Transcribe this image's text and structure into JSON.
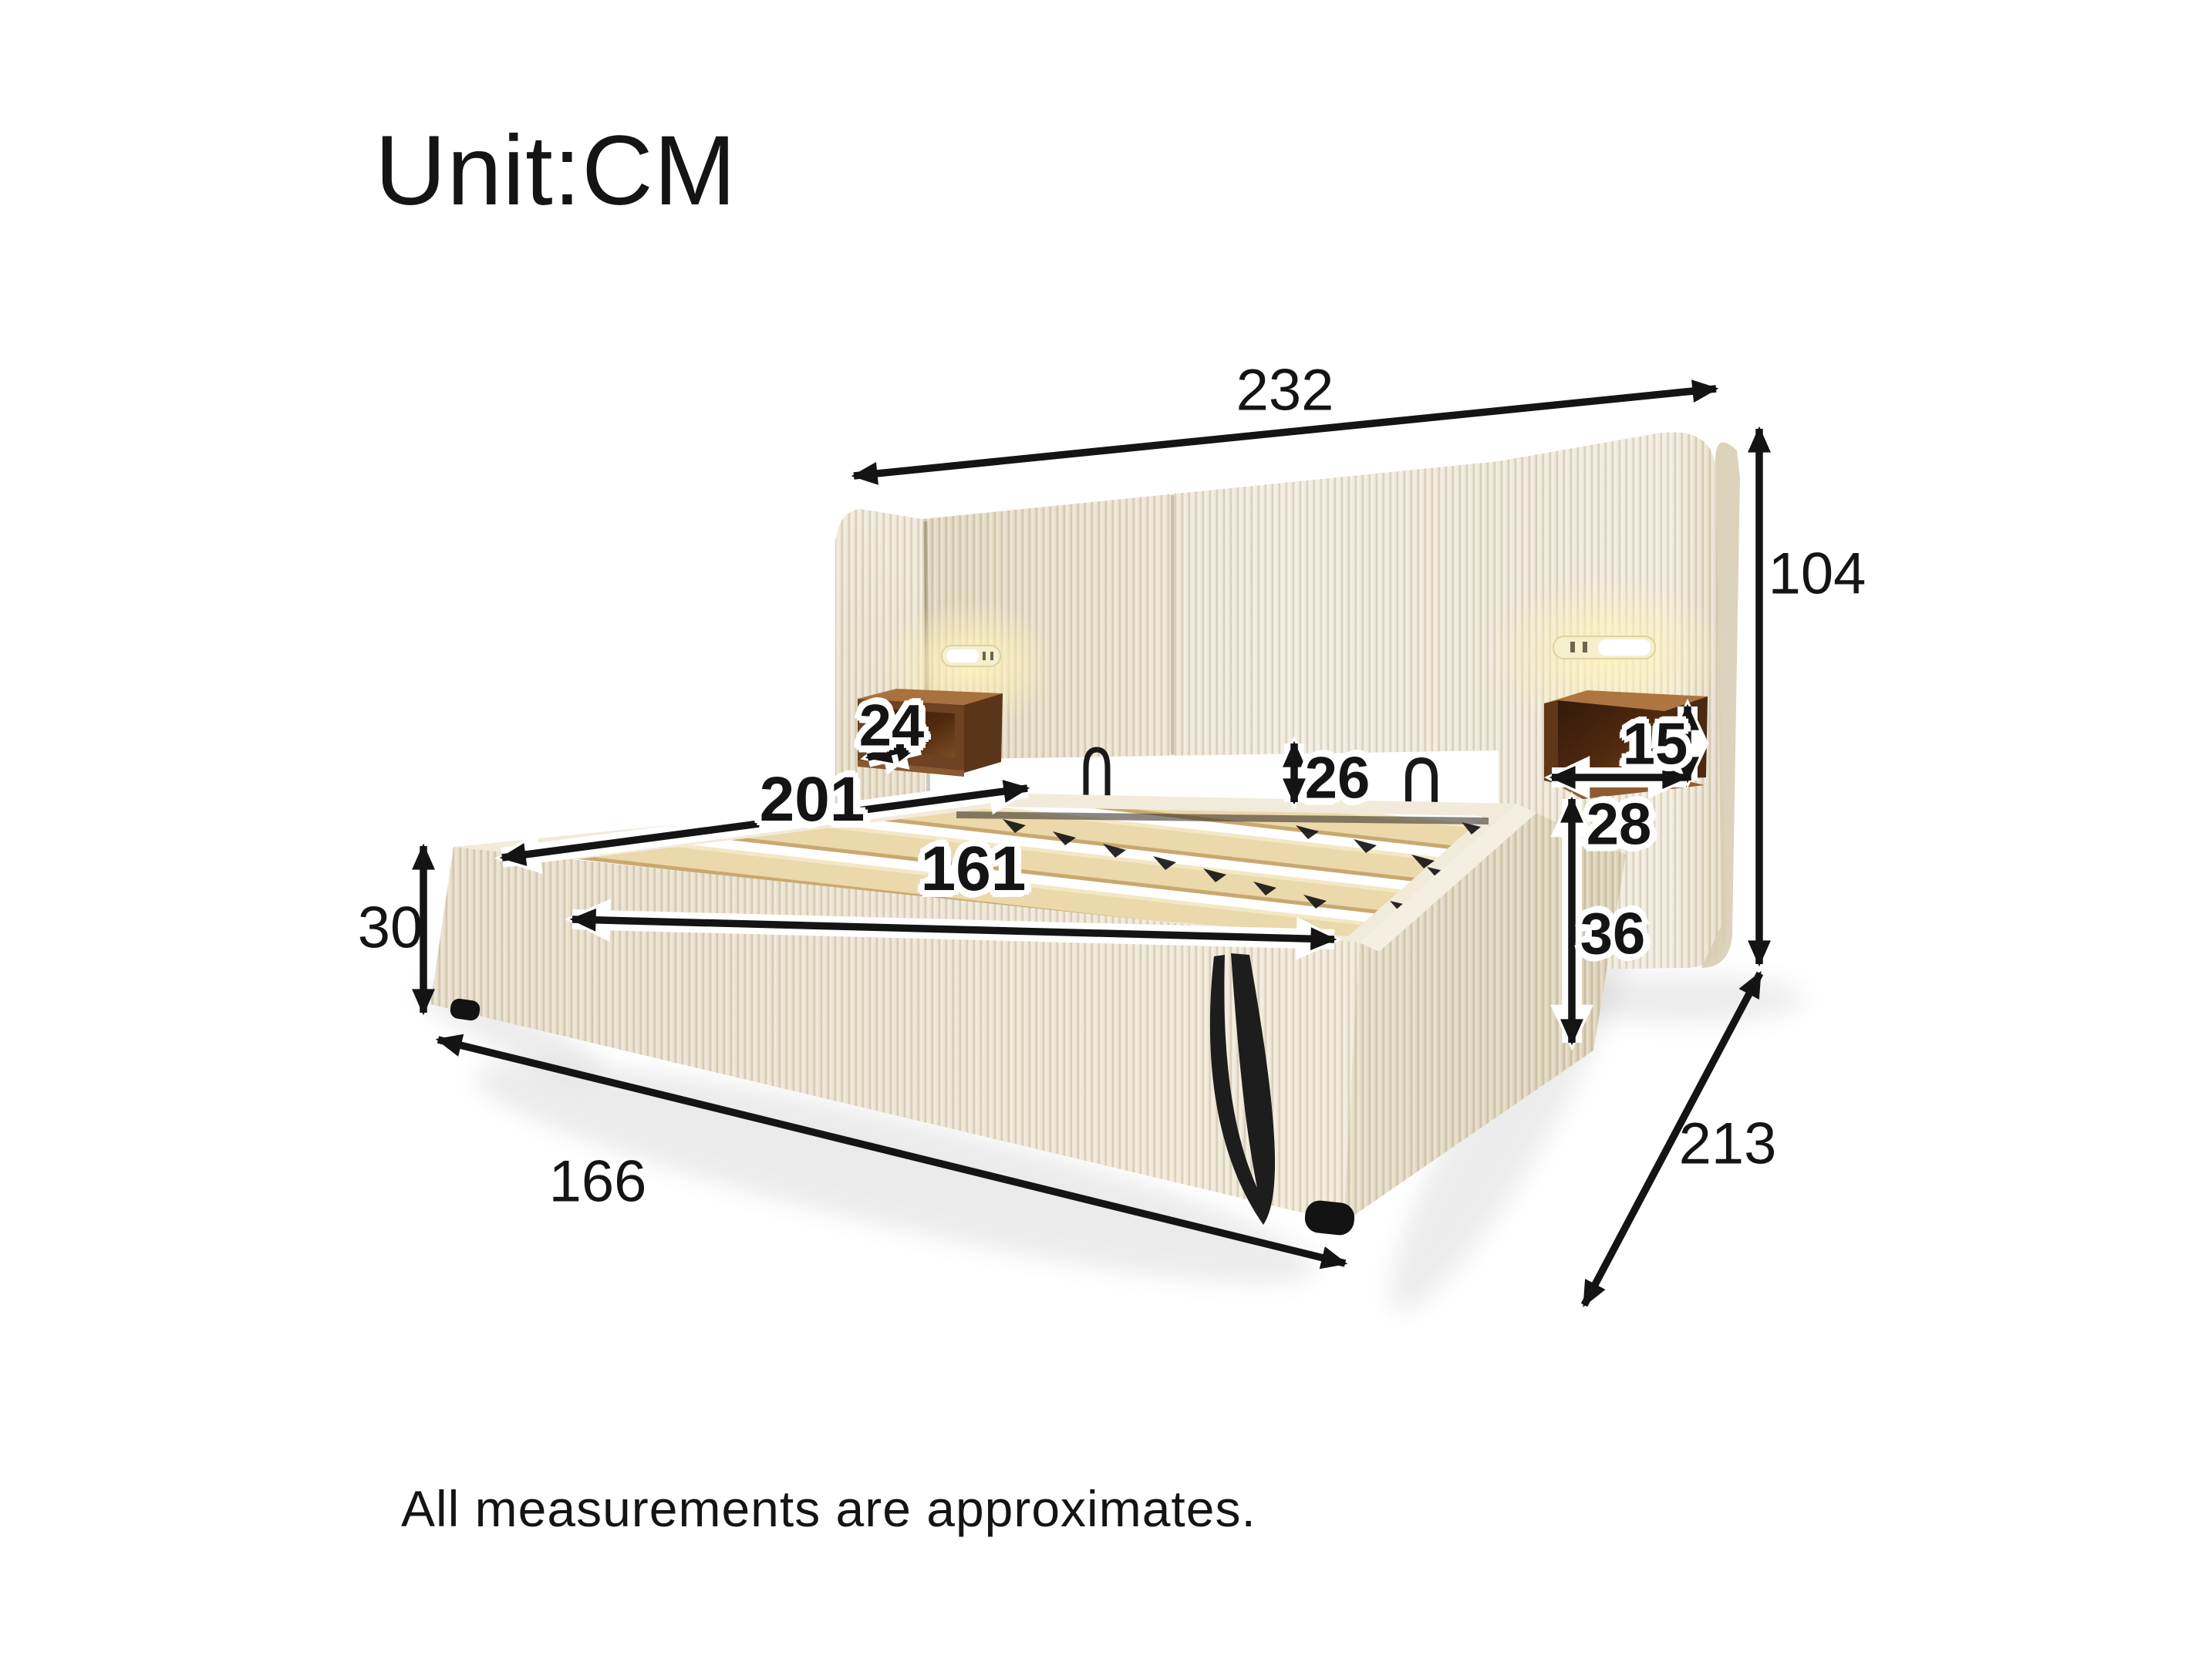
{
  "unit_label": "Unit:CM",
  "note": "All measurements are approximates.",
  "dimensions": {
    "overall_width": "232",
    "headboard_height": "104",
    "overall_depth": "213",
    "base_front_width": "166",
    "base_height": "30",
    "inner_length": "201",
    "inner_width": "161",
    "headboard_gap_height": "26",
    "left_shelf_depth": "24",
    "right_shelf_height": "15",
    "right_shelf_width": "28",
    "right_side_height": "36"
  },
  "colors": {
    "background": "#ffffff",
    "fabric": "#ece3d1",
    "fabric_shadow": "#ddd2bb",
    "wood_top": "#a8713d",
    "wood_dark": "#3a1f0e",
    "slat": "#ebd8ab",
    "arrow": "#141414",
    "led_glow": "#ffefb8"
  }
}
